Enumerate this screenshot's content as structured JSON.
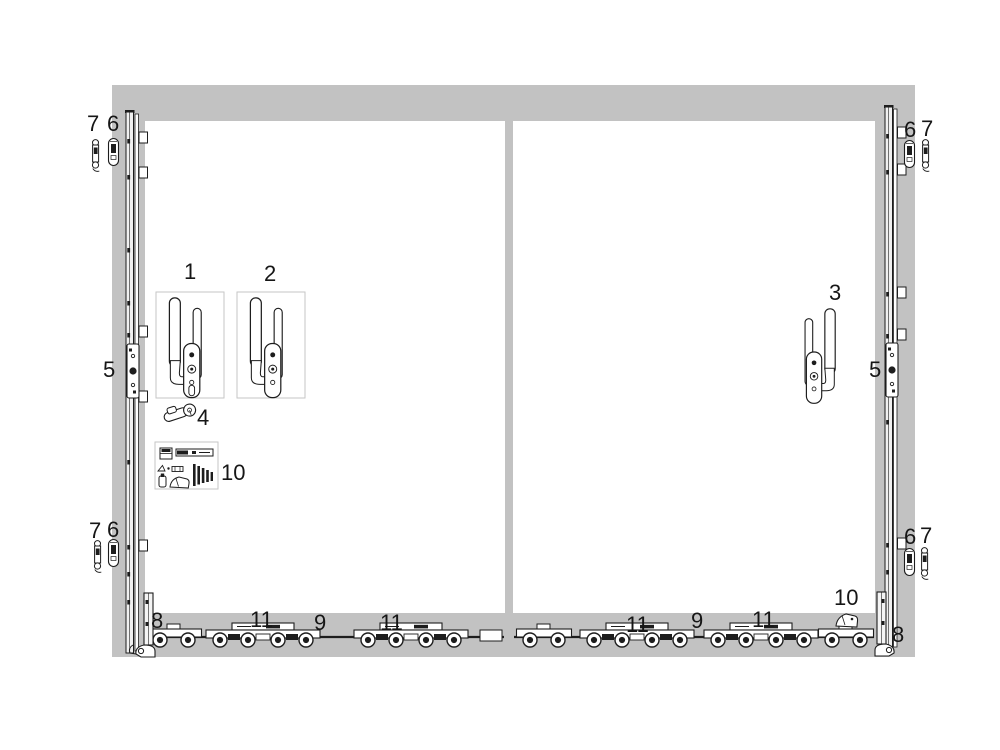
{
  "callouts": {
    "handle_1": "1",
    "handle_2": "2",
    "handle_3": "3",
    "cylinder": "4",
    "gearbox_left": "5",
    "gearbox_right": "5",
    "top_left_outer": "7",
    "top_left_inner": "6",
    "top_right_inner": "6",
    "top_right_outer": "7",
    "bottom_left_outer": "7",
    "bottom_left_inner": "6",
    "bottom_right_inner": "6",
    "bottom_right_outer": "7",
    "corner_bottom_left": "8",
    "corner_bottom_right": "8",
    "carriage_left_a": "11",
    "rod_left": "9",
    "carriage_left_b": "11",
    "carriage_right_a": "11",
    "rod_right": "9",
    "carriage_right_b": "11",
    "accessory_box": "10",
    "end_cap": "10"
  },
  "colors": {
    "frame": "#c2c2c2",
    "line": "#1d1d1d",
    "label": "#161616",
    "box_border": "#c6c6c6"
  }
}
